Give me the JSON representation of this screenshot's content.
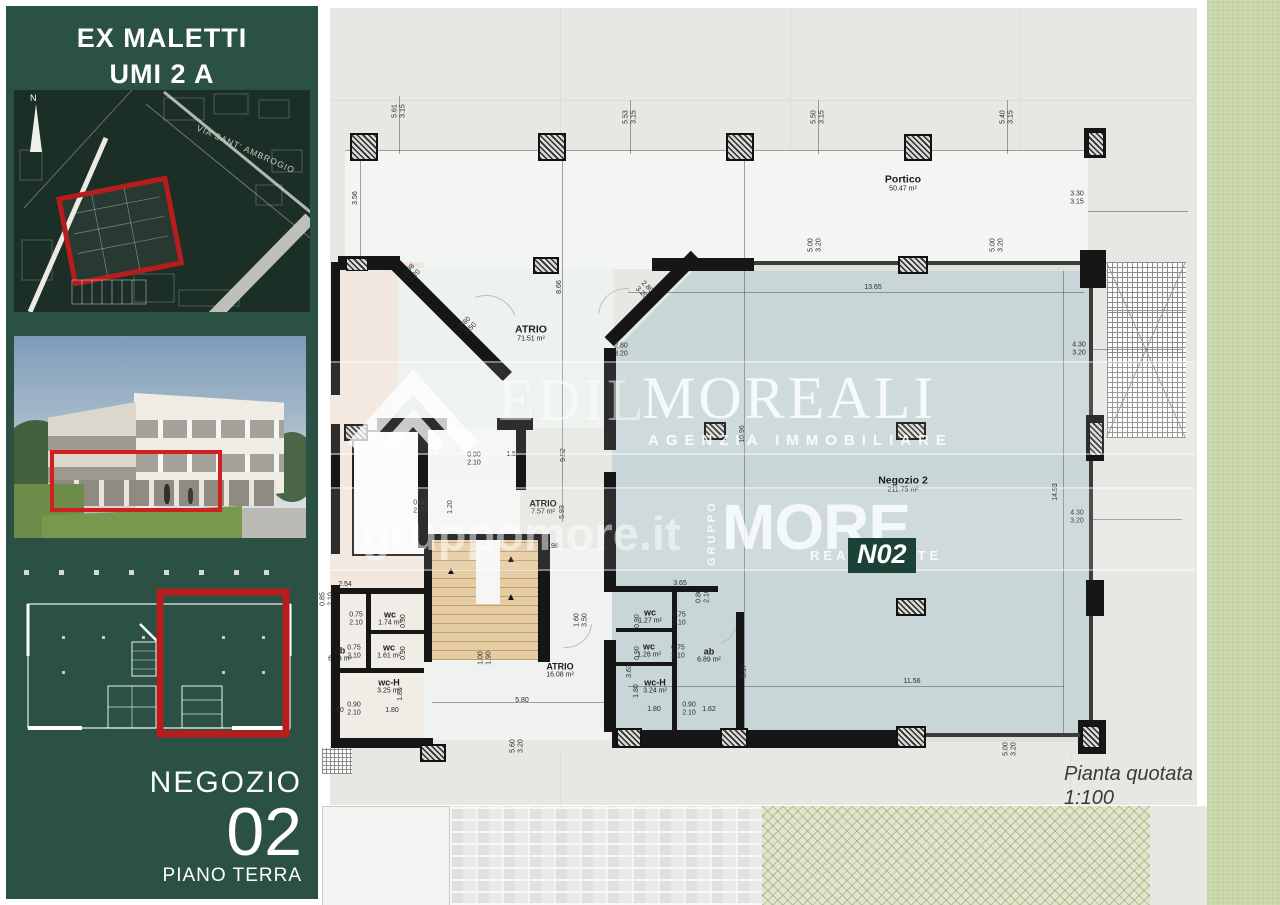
{
  "sidebar": {
    "title_line1": "EX MALETTI",
    "title_line2": "UMI 2 A",
    "map": {
      "north_label": "N",
      "street_label": "VIA SANT' AMBROGIO"
    },
    "unit_label": "NEGOZIO",
    "unit_number": "02",
    "floor_label": "PIANO TERRA"
  },
  "plan": {
    "caption_title": "Pianta quotata",
    "caption_scale": "1:100",
    "rooms": [
      {
        "name": "Portico",
        "area": "50.47 m²",
        "x": 903,
        "y": 183,
        "cls": "big"
      },
      {
        "name": "ATRIO",
        "area": "71.51 m²",
        "x": 531,
        "y": 333,
        "cls": "big"
      },
      {
        "name": "ATRIO",
        "area": "7.57 m²",
        "x": 543,
        "y": 507,
        "cls": ""
      },
      {
        "name": "ATRIO",
        "area": "16.08 m²",
        "x": 560,
        "y": 670,
        "cls": ""
      },
      {
        "name": "Negozio 2",
        "area": "211.75 m²",
        "x": 903,
        "y": 484,
        "cls": "big"
      },
      {
        "name": "wc",
        "area": "1.74 m²",
        "x": 390,
        "y": 618,
        "cls": ""
      },
      {
        "name": "wc",
        "area": "1.61 m²",
        "x": 389,
        "y": 651,
        "cls": ""
      },
      {
        "name": "wc-H",
        "area": "3.25 m²",
        "x": 389,
        "y": 686,
        "cls": ""
      },
      {
        "name": "ab",
        "area": "6.13 m²",
        "x": 340,
        "y": 654,
        "cls": ""
      },
      {
        "name": "wc",
        "area": "1.27 m²",
        "x": 650,
        "y": 616,
        "cls": ""
      },
      {
        "name": "wc",
        "area": "1.26 m²",
        "x": 649,
        "y": 650,
        "cls": ""
      },
      {
        "name": "wc-H",
        "area": "3.24 m²",
        "x": 655,
        "y": 686,
        "cls": ""
      },
      {
        "name": "ab",
        "area": "6.89 m²",
        "x": 709,
        "y": 655,
        "cls": ""
      }
    ],
    "dimensions": [
      {
        "t": "5.61\n3.15",
        "x": 399,
        "y": 111,
        "r": -90
      },
      {
        "t": "5.53\n3.15",
        "x": 630,
        "y": 117,
        "r": -90
      },
      {
        "t": "5.50\n3.15",
        "x": 818,
        "y": 117,
        "r": -90
      },
      {
        "t": "5.40\n3.15",
        "x": 1007,
        "y": 117,
        "r": -90
      },
      {
        "t": "3.30\n3.15",
        "x": 1077,
        "y": 198,
        "r": 0
      },
      {
        "t": "3.56",
        "x": 356,
        "y": 198,
        "r": -90
      },
      {
        "t": "8.66",
        "x": 560,
        "y": 287,
        "r": -90
      },
      {
        "t": "9.52",
        "x": 564,
        "y": 455,
        "r": -90
      },
      {
        "t": "5.93",
        "x": 563,
        "y": 512,
        "r": -90
      },
      {
        "t": "10.96",
        "x": 743,
        "y": 434,
        "r": -90
      },
      {
        "t": "14.93",
        "x": 1056,
        "y": 492,
        "r": -90
      },
      {
        "t": "4.30\n3.20",
        "x": 1079,
        "y": 349,
        "r": 0
      },
      {
        "t": "4.30\n3.20",
        "x": 1077,
        "y": 517,
        "r": 0
      },
      {
        "t": "13.65",
        "x": 873,
        "y": 288,
        "r": 0
      },
      {
        "t": "11.56",
        "x": 912,
        "y": 682,
        "r": 0
      },
      {
        "t": "2.98\n3.20",
        "x": 412,
        "y": 273,
        "r": -45
      },
      {
        "t": "2.80\n3.50",
        "x": 468,
        "y": 326,
        "r": -45
      },
      {
        "t": "2.80\n3.20",
        "x": 644,
        "y": 290,
        "r": 45
      },
      {
        "t": "2.80\n3.20",
        "x": 621,
        "y": 350,
        "r": 0
      },
      {
        "t": "0.90\n2.10",
        "x": 474,
        "y": 459,
        "r": 0
      },
      {
        "t": "1.53",
        "x": 513,
        "y": 455,
        "r": 0
      },
      {
        "t": "0.80\n2.70",
        "x": 420,
        "y": 507,
        "r": 0
      },
      {
        "t": "1.20",
        "x": 451,
        "y": 507,
        "r": -90
      },
      {
        "t": "1.98",
        "x": 552,
        "y": 547,
        "r": 0
      },
      {
        "t": "2.54",
        "x": 345,
        "y": 585,
        "r": 0
      },
      {
        "t": "0.85\n2.10",
        "x": 327,
        "y": 599,
        "r": -90
      },
      {
        "t": "0.75\n2.10",
        "x": 356,
        "y": 619,
        "r": 0
      },
      {
        "t": "0.90",
        "x": 404,
        "y": 621,
        "r": -90
      },
      {
        "t": "0.75\n2.10",
        "x": 354,
        "y": 652,
        "r": 0
      },
      {
        "t": "0.90",
        "x": 404,
        "y": 653,
        "r": -90
      },
      {
        "t": "1.81",
        "x": 401,
        "y": 694,
        "r": -90
      },
      {
        "t": "1.60",
        "x": 337,
        "y": 711,
        "r": 0
      },
      {
        "t": "0.90\n2.10",
        "x": 354,
        "y": 709,
        "r": 0
      },
      {
        "t": "1.80",
        "x": 392,
        "y": 711,
        "r": 0
      },
      {
        "t": "1.00\n1.90",
        "x": 485,
        "y": 658,
        "r": -90
      },
      {
        "t": "5.80",
        "x": 522,
        "y": 701,
        "r": 0
      },
      {
        "t": "1.60\n3.50",
        "x": 581,
        "y": 620,
        "r": -90
      },
      {
        "t": "3.63",
        "x": 630,
        "y": 671,
        "r": -90
      },
      {
        "t": "5.60\n3.20",
        "x": 517,
        "y": 746,
        "r": -90
      },
      {
        "t": "3.65",
        "x": 680,
        "y": 584,
        "r": 0
      },
      {
        "t": "0.80\n2.10",
        "x": 703,
        "y": 596,
        "r": -90
      },
      {
        "t": "0.90",
        "x": 638,
        "y": 621,
        "r": -90
      },
      {
        "t": "0.75\n2.10",
        "x": 679,
        "y": 619,
        "r": 0
      },
      {
        "t": "0.90",
        "x": 638,
        "y": 653,
        "r": -90
      },
      {
        "t": "0.75\n2.10",
        "x": 678,
        "y": 652,
        "r": 0
      },
      {
        "t": "1.80",
        "x": 637,
        "y": 691,
        "r": -90
      },
      {
        "t": "1.80",
        "x": 654,
        "y": 710,
        "r": 0
      },
      {
        "t": "0.90\n2.10",
        "x": 689,
        "y": 709,
        "r": 0
      },
      {
        "t": "1.62",
        "x": 709,
        "y": 710,
        "r": 0
      },
      {
        "t": "3.97",
        "x": 745,
        "y": 671,
        "r": -90
      },
      {
        "t": "5.00\n3.20",
        "x": 815,
        "y": 245,
        "r": -90
      },
      {
        "t": "5.00\n3.20",
        "x": 997,
        "y": 245,
        "r": -90
      },
      {
        "t": "5.00\n3.20",
        "x": 1010,
        "y": 749,
        "r": -90
      }
    ]
  },
  "watermarks": {
    "brand_serif_left": "EDIL",
    "brand_serif_right": "MOREALI",
    "brand_sub": "AGENZIA IMMOBILIARE",
    "website": "gruppomore.it",
    "group_vertical": "GRUPPO",
    "brand_bold": "MORE",
    "brand_bold_sub": "REAL ESTATE",
    "unit_badge": "N02"
  },
  "colors": {
    "sidebar_green": "#2b5144",
    "highlight_red": "#b81d1d",
    "shop_fill": "#c9d6d7",
    "stairs_fill": "#e6cca3",
    "lawn_green": "#cbd8ac",
    "wall_black": "#161616",
    "badge_green": "#1c4136"
  }
}
